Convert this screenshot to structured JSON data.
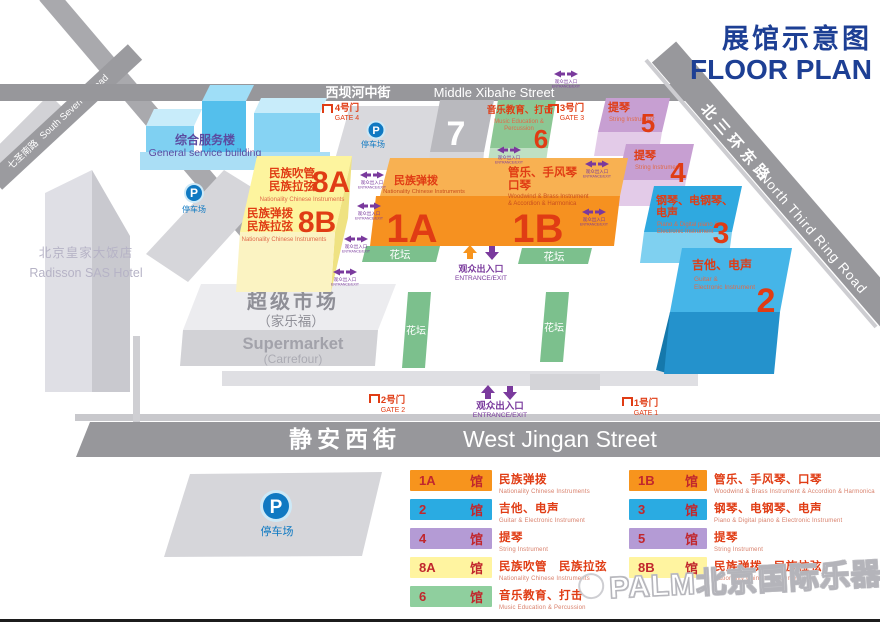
{
  "title": {
    "zh": "展馆示意图",
    "en": "FLOOR PLAN"
  },
  "roads": {
    "xibahe": {
      "zh": "西坝河中街",
      "en": "Middle Xibahe Street"
    },
    "south_seven": {
      "zh": "七圣南路",
      "en": "South Seven st Road"
    },
    "ring_road": {
      "zh": "北三环东路",
      "en": "North Third Ring Road"
    },
    "jingan": {
      "zh": "静安西街",
      "en": "West Jingan Street"
    }
  },
  "buildings": {
    "service": {
      "zh": "综合服务楼",
      "en": "General service building"
    },
    "hotel": {
      "zh": "北京皇家大饭店",
      "en": "Radisson SAS Hotel"
    },
    "supermarket": {
      "zh": "超级市场",
      "zh_sub": "（家乐福）",
      "en": "Supermarket",
      "en_sub": "(Carrefour)"
    }
  },
  "parking": {
    "symbol": "P",
    "label": "停车场"
  },
  "halls": {
    "h7": {
      "num": "7"
    },
    "h6": {
      "num": "6",
      "zh": "音乐教育、打击",
      "en1": "Music Education &",
      "en2": "Percussion"
    },
    "h5": {
      "num": "5",
      "zh": "提琴",
      "en": "String Instrument"
    },
    "h4": {
      "num": "4",
      "zh": "提琴",
      "en": "String Instrument"
    },
    "h3": {
      "num": "3",
      "zh1": "钢琴、电钢琴、",
      "zh2": "电声",
      "en1": "Piano & Digital piano &",
      "en2": "Electronic Instrument"
    },
    "h2": {
      "num": "2",
      "zh": "吉他、电声",
      "en1": "Guitar &",
      "en2": "Electronic Instrument"
    },
    "h8a": {
      "num": "8A",
      "zh1": "民族吹管",
      "zh2": "民族拉弦",
      "en": "Nationality Chinese Instruments"
    },
    "h8b": {
      "num": "8B",
      "zh1": "民族弹拨",
      "zh2": "民族拉弦",
      "en": "Nationality Chinese Instruments"
    },
    "h1a": {
      "num": "1A",
      "zh": "民族弹拨",
      "en": "Nationality Chinese Instruments"
    },
    "h1b": {
      "num": "1B",
      "zh1": "管乐、手风琴",
      "zh2": "口琴",
      "en1": "Woodwind & Brass Instrument",
      "en2": "& Accordion & Harmonica"
    }
  },
  "gates": {
    "gate1": {
      "zh": "1号门",
      "en": "GATE 1"
    },
    "gate2": {
      "zh": "2号门",
      "en": "GATE 2"
    },
    "gate3": {
      "zh": "3号门",
      "en": "GATE 3"
    },
    "gate4": {
      "zh": "4号门",
      "en": "GATE 4"
    }
  },
  "entrance": {
    "zh": "观众出入口",
    "en": "ENTRANCE/EXIT"
  },
  "flowerbed": {
    "label": "花坛"
  },
  "legend": {
    "left": [
      {
        "num": "1A",
        "suffix": "馆",
        "color": "#f7941d",
        "zh": "民族弹拨",
        "en": "Nationality Chinese Instruments"
      },
      {
        "num": "2",
        "suffix": "馆",
        "color": "#2aabe2",
        "zh": "吉他、电声",
        "en": "Guitar & Electronic Instrument"
      },
      {
        "num": "4",
        "suffix": "馆",
        "color": "#b49bd5",
        "zh": "提琴",
        "en": "String Instrument"
      },
      {
        "num": "8A",
        "suffix": "馆",
        "color": "#fff4a0",
        "zh": "民族吹管　民族拉弦",
        "en": "Nationality Chinese Instruments"
      },
      {
        "num": "6",
        "suffix": "馆",
        "color": "#8fcf9e",
        "zh": "音乐教育、打击",
        "en": "Music Education & Percussion"
      }
    ],
    "right": [
      {
        "num": "1B",
        "suffix": "馆",
        "color": "#f7941d",
        "zh": "管乐、手风琴、口琴",
        "en": "Woodwind & Brass Instrument & Accordion & Harmonica"
      },
      {
        "num": "3",
        "suffix": "馆",
        "color": "#2aabe2",
        "zh": "钢琴、电钢琴、电声",
        "en": "Piano & Digital piano & Electronic Instrument"
      },
      {
        "num": "5",
        "suffix": "馆",
        "color": "#b49bd5",
        "zh": "提琴",
        "en": "String Instrument"
      },
      {
        "num": "8B",
        "suffix": "馆",
        "color": "#fff4a0",
        "zh": "民族弹拨　民族拉弦",
        "en": "Nationality Chinese Instruments"
      }
    ]
  },
  "watermark": "PALM北京国际乐器展",
  "colors": {
    "navy": "#1d3f94",
    "red": "#e03c14",
    "road_gray": "#97979b",
    "hall_orange": "#f69120",
    "hall_blue": "#29abe2",
    "hall_purple": "#c79fd2",
    "hall_yellow": "#fdf49e",
    "hall_green": "#8cc794",
    "flower_green": "#7cc08d",
    "parking_blue": "#0f79c2",
    "entrance_purple": "#7a3a9d"
  }
}
